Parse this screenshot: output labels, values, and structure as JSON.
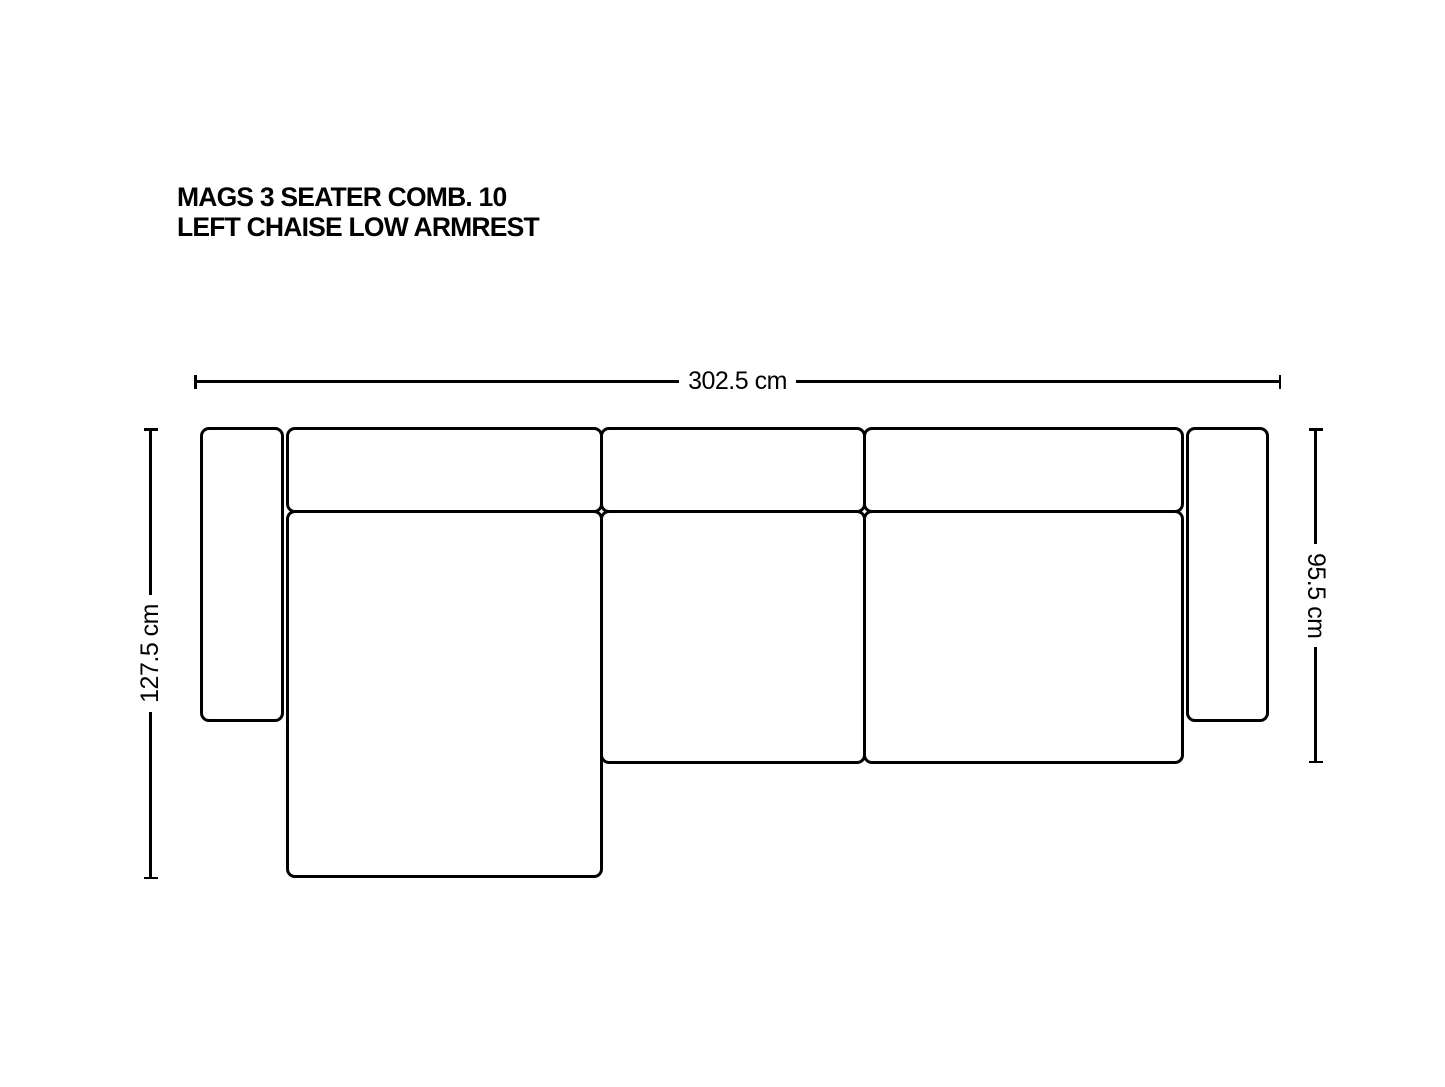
{
  "page": {
    "background": "#ffffff",
    "line_color": "#000000"
  },
  "title": {
    "line1": "MAGS 3 SEATER COMB. 10",
    "line2": "LEFT CHAISE LOW ARMREST"
  },
  "dimensions": {
    "overall_width": {
      "label": "302.5 cm",
      "value_cm": 302.5,
      "orientation": "horizontal"
    },
    "chaise_depth": {
      "label": "127.5 cm",
      "value_cm": 127.5,
      "orientation": "vertical-left"
    },
    "sofa_depth": {
      "label": "95.5 cm",
      "value_cm": 95.5,
      "orientation": "vertical-right"
    }
  },
  "modules": [
    {
      "name": "left-armrest"
    },
    {
      "name": "chaise-backrest"
    },
    {
      "name": "middle-backrest"
    },
    {
      "name": "right-backrest"
    },
    {
      "name": "chaise-seat"
    },
    {
      "name": "middle-seat"
    },
    {
      "name": "right-seat"
    },
    {
      "name": "right-armrest"
    }
  ]
}
